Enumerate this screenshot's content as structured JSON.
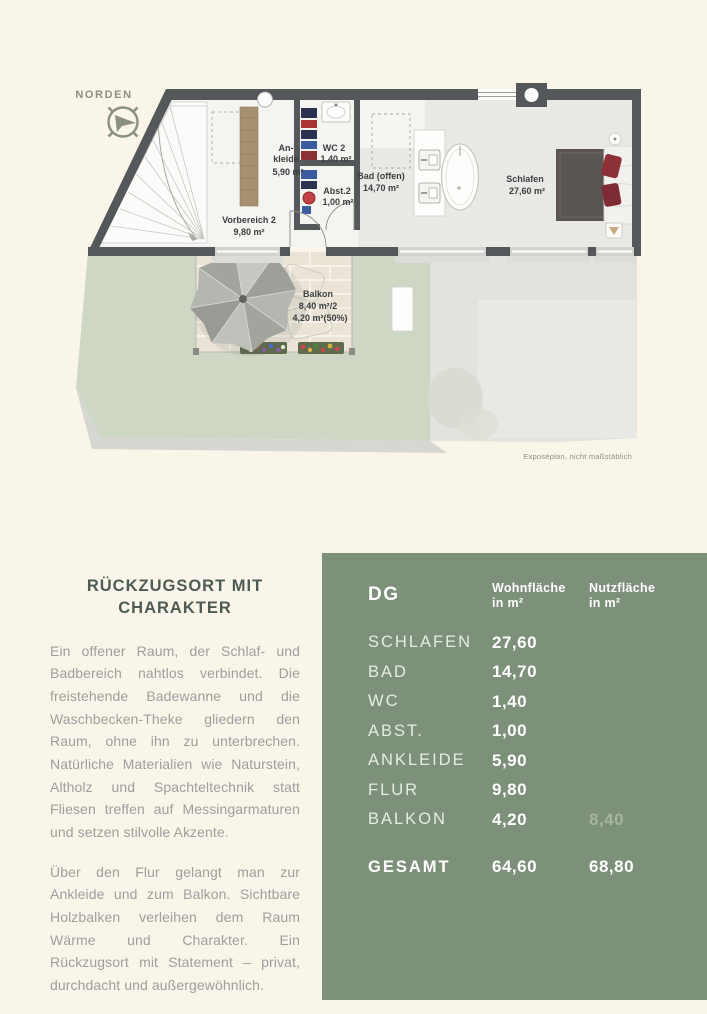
{
  "colors": {
    "page_bg": "#f9f5e8",
    "panel": "#7d907a",
    "heading": "#4e5b54",
    "body_text": "#9e9e9e",
    "accent": "#8a9181",
    "wall": "#55585a",
    "lawn": "#cdd7c4",
    "plan_floor": "#e9eae6"
  },
  "compass": {
    "label": "NORDEN"
  },
  "floor_plan": {
    "rooms": {
      "ankleide": {
        "name_line1": "An-",
        "name_line2": "kleide",
        "area": "5,90 m²"
      },
      "wc": {
        "name": "WC 2",
        "area": "1,40 m²"
      },
      "abstellraum": {
        "name": "Abst.2",
        "area": "1,00 m²"
      },
      "vorbereich": {
        "name": "Vorbereich 2",
        "area": "9,80 m²"
      },
      "bad": {
        "name": "Bad (offen)",
        "area": "14,70 m²"
      },
      "schlafen": {
        "name": "Schlafen",
        "area": "27,60 m²"
      },
      "balkon": {
        "name": "Balkon",
        "area_line1": "8,40 m²/2",
        "area_line2": "4,20 m²(50%)"
      }
    },
    "caption": "Exposéplan, nicht maßstäblich"
  },
  "article": {
    "heading_line1": "RÜCKZUGSORT MIT",
    "heading_line2": "CHARAKTER",
    "paragraphs": [
      "Ein offener Raum, der Schlaf- und Badbereich nahtlos verbindet. Die freistehende Badewanne und die Waschbecken-Theke gliedern den Raum, ohne ihn zu unterbrechen. Natürliche Materialien wie Naturstein, Altholz und Spachteltechnik statt Fliesen treffen auf Messingarmaturen und setzen stilvolle Akzente.",
      "Über den Flur gelangt man zur Ankleide und zum Balkon. Sichtbare Holzbalken verleihen dem Raum Wärme und Charakter. Ein Rückzugsort mit Statement – privat, durchdacht und außergewöhnlich."
    ]
  },
  "area_table": {
    "floor_label": "DG",
    "col1_header_line1": "Wohnfläche",
    "col1_header_line2": "in m²",
    "col2_header_line1": "Nutzfläche",
    "col2_header_line2": "in m²",
    "rows": [
      {
        "label": "SCHLAFEN",
        "wohnflaeche": "27,60",
        "nutzflaeche": ""
      },
      {
        "label": "BAD",
        "wohnflaeche": "14,70",
        "nutzflaeche": ""
      },
      {
        "label": "WC",
        "wohnflaeche": "1,40",
        "nutzflaeche": ""
      },
      {
        "label": "ABST.",
        "wohnflaeche": "1,00",
        "nutzflaeche": ""
      },
      {
        "label": "ANKLEIDE",
        "wohnflaeche": "5,90",
        "nutzflaeche": ""
      },
      {
        "label": "FLUR",
        "wohnflaeche": "9,80",
        "nutzflaeche": ""
      },
      {
        "label": "BALKON",
        "wohnflaeche": "4,20",
        "nutzflaeche": "8,40"
      }
    ],
    "total": {
      "label": "GESAMT",
      "wohnflaeche": "64,60",
      "nutzflaeche": "68,80"
    }
  }
}
